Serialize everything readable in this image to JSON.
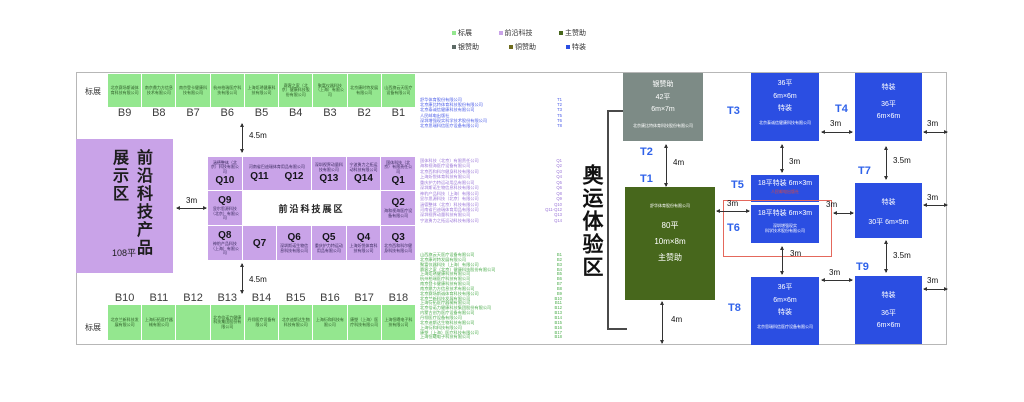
{
  "legend": {
    "items": [
      {
        "label": "标展",
        "color": "#94e78f"
      },
      {
        "label": "前沿科技",
        "color": "#c9a3e8"
      },
      {
        "label": "主赞助",
        "color": "#47671c"
      },
      {
        "label": "银赞助",
        "color": "#5d6a66"
      },
      {
        "label": "铜赞助",
        "color": "#6e6b1d"
      },
      {
        "label": "特装",
        "color": "#2b4ee2"
      }
    ]
  },
  "colors": {
    "standard_booth": "#94e78f",
    "frontier_zone": "#c9a3e8",
    "main_sponsor": "#47671c",
    "silver_sponsor": "#7d8b86",
    "bronze_sponsor": "#6e6b1d",
    "special_booth": "#2b4ee2",
    "t_label_text": "#2f62ea",
    "red_highlight": "#e4685c"
  },
  "labels": {
    "standard_top": "标展",
    "standard_bottom": "标展"
  },
  "hall": {
    "top_row": [
      {
        "code": "B9",
        "company": "北京赛场斯诚体育科技有限公司"
      },
      {
        "code": "B8",
        "company": "南京鼎力方信息技术有限公司"
      },
      {
        "code": "B7",
        "company": "南京登卡健康科技有限公司"
      },
      {
        "code": "B6",
        "company": "杭州柏瑞医疗科技有限公司"
      },
      {
        "code": "B5",
        "company": "上海炬琇健康科技有限公司"
      },
      {
        "code": "B4",
        "company": "赛客之家（北京）健康科技股份有限公司"
      },
      {
        "code": "B3",
        "company": "聚富仪器科技（上海）有限公司"
      },
      {
        "code": "B2",
        "company": "北京康时特发展有限公司"
      },
      {
        "code": "B1",
        "company": "山西旗云天医疗设备有限公司"
      }
    ],
    "bottom_row": [
      {
        "code": "B10",
        "company": "北京兰新科技发展有限公司"
      },
      {
        "code": "B11",
        "company": "上海衍拓医疗器械有限公司"
      },
      {
        "code": "B12",
        "company": ""
      },
      {
        "code": "B13",
        "company": "北京倍诺力健康科技集团股份有限公司"
      },
      {
        "code": "B14",
        "company": "丹翎医疗设备有限公司"
      },
      {
        "code": "B15",
        "company": "北京迪斯达生物科技有限公司"
      },
      {
        "code": "B16",
        "company": "上海衍和科技有限公司"
      },
      {
        "code": "B17",
        "company": "康塑（上海）医疗科技有限公司"
      },
      {
        "code": "B18",
        "company": "上海恒曦电子科技有限公司"
      }
    ]
  },
  "frontier_zone": {
    "title_right": "前沿科技",
    "title_left": "产品展示区",
    "area": "108平"
  },
  "q_grid": {
    "center_label": "前沿科技展区",
    "q10": {
      "code": "Q10",
      "company": "涵德整体（北京）科技有限公司"
    },
    "q11_12": {
      "code_a": "Q11",
      "code_b": "Q12",
      "company": "河南省巴迪瑞体育用品有限公司"
    },
    "q13": {
      "code": "Q13",
      "company": "深圳视界动量科技有限公司"
    },
    "q14": {
      "code": "Q14",
      "company": "宁波勇力之拓运动科技有限公司"
    },
    "q1": {
      "code": "Q1",
      "company": "国体科技（北京）有限责任公司"
    },
    "q9": {
      "code": "Q9",
      "company": "显尔思源科技（北京）有限公司"
    },
    "q2": {
      "code": "Q2",
      "company": "海和视海医疗设备有限公司"
    },
    "q8": {
      "code": "Q8",
      "company": "神豹产品科技（上海）有限公司"
    },
    "q7": {
      "code": "Q7",
      "company": ""
    },
    "q6": {
      "code": "Q6",
      "company": "深圳斯诺生物信息科技有限公司"
    },
    "q5": {
      "code": "Q5",
      "company": "重庆护力特运动用品有限公司"
    },
    "q4": {
      "code": "Q4",
      "company": "上海炘悦体育科技有限公司"
    },
    "q3": {
      "code": "Q3",
      "company": "北京西和科尔健身科技有限公司"
    }
  },
  "directory": {
    "t_list": [
      {
        "name": "舒华体育股份有限公司",
        "code": "T1"
      },
      {
        "name": "北京康比特体育科技股份有限公司",
        "code": "T2"
      },
      {
        "name": "北京泰诚信健康科技有限公司",
        "code": "T3"
      },
      {
        "name": "人民邮电出版社",
        "code": "T5"
      },
      {
        "name": "深圳增强现实科学技术股份有限公司",
        "code": "T6"
      },
      {
        "name": "北京思瑞科信医疗设备有限公司",
        "code": "T8"
      }
    ],
    "q_list": [
      {
        "name": "国体科技（北京）有限责任公司",
        "code": "Q1"
      },
      {
        "name": "海和视海医疗设备有限公司",
        "code": "Q2"
      },
      {
        "name": "北京西和科尔健身科技有限公司",
        "code": "Q3"
      },
      {
        "name": "上海炘悦体育科技有限公司",
        "code": "Q4"
      },
      {
        "name": "重庆护力特运动用品有限公司",
        "code": "Q5"
      },
      {
        "name": "深圳斯诺生物信息科技有限公司",
        "code": "Q6"
      },
      {
        "name": "神豹产品科技（上海）有限公司",
        "code": "Q8"
      },
      {
        "name": "显尔思源科技（北京）有限公司",
        "code": "Q9"
      },
      {
        "name": "涵德整体（北京）科技有限公司",
        "code": "Q10"
      },
      {
        "name": "河南省巴迪瑞体育用品有限公司",
        "code": "Q11-Q12"
      },
      {
        "name": "深圳视界动量科技有限公司",
        "code": "Q13"
      },
      {
        "name": "宁波勇力之拓运动科技有限公司",
        "code": "Q14"
      }
    ],
    "b_list": [
      {
        "name": "山西旗云天医疗设备有限公司",
        "code": "B1"
      },
      {
        "name": "北京康时特发展有限公司",
        "code": "B2"
      },
      {
        "name": "聚富仪器科技（上海）有限公司",
        "code": "B3"
      },
      {
        "name": "赛客之家（北京）健康科技股份有限公司",
        "code": "B4"
      },
      {
        "name": "上海炬琇健康科技有限公司",
        "code": "B5"
      },
      {
        "name": "杭州柏瑞医疗科技有限公司",
        "code": "B6"
      },
      {
        "name": "南京登卡健康科技有限公司",
        "code": "B7"
      },
      {
        "name": "南京鼎力方信息技术有限公司",
        "code": "B8"
      },
      {
        "name": "北京赛场斯诚体育科技有限公司",
        "code": "B9"
      },
      {
        "name": "北京兰新科技发展有限公司",
        "code": "B10"
      },
      {
        "name": "上海衍拓医疗器械有限公司",
        "code": "B11"
      },
      {
        "name": "北京倍诺力健康科技集团股份有限公司",
        "code": "B12"
      },
      {
        "name": "内蒙古创为医疗设备有限公司",
        "code": "B13"
      },
      {
        "name": "丹翎医疗设备有限公司",
        "code": "B14"
      },
      {
        "name": "北京迪斯达生物科技有限公司",
        "code": "B15"
      },
      {
        "name": "上海衍和科技有限公司",
        "code": "B16"
      },
      {
        "name": "康塑（上海）医疗科技有限公司",
        "code": "B17"
      },
      {
        "name": "上海恒曦电子科技有限公司",
        "code": "B18"
      }
    ]
  },
  "dims": {
    "top_aisle": "4.5m",
    "bottom_aisle": "4.5m",
    "purple_gap": "3m",
    "silver_main_gap": "4m",
    "main_bottom_gap": "4m",
    "t3_t4": "3m",
    "t4_edge": "3m",
    "t3_t5": "3m",
    "t4_t7": "3.5m",
    "t7_edge": "3m",
    "main_t5": "3m",
    "t6_t7": "3m",
    "t6_t8": "3m",
    "t8_t9": "3m",
    "t7_t9": "3.5m",
    "t9_edge": "3m"
  },
  "olympic": {
    "zone_label": "奥运体验区",
    "t_labels": {
      "t1": "T1",
      "t2": "T2",
      "t3": "T3",
      "t4": "T4",
      "t5": "T5",
      "t6": "T6",
      "t7": "T7",
      "t8": "T8",
      "t9": "T9"
    },
    "silver_box": {
      "lines": [
        "银赞助",
        "42平",
        "6m×7m"
      ],
      "company": "北京康比特体育科技股份有限公司"
    },
    "main_box": {
      "company": "舒华体育股份有限公司",
      "lines": [
        "80平",
        "10m×8m",
        "主赞助"
      ]
    },
    "t3_box": {
      "lines": [
        "36平",
        "6m×6m",
        "特装"
      ],
      "company": "北京泰诚信健康科技有限公司"
    },
    "t4_box": {
      "lines": [
        "特装",
        "36平",
        "6m×6m"
      ]
    },
    "t5_box": {
      "text": "18平特装 6m×3m",
      "company": "人民邮电出版社"
    },
    "t6_box": {
      "text": "18平特装 6m×3m",
      "company_lines": [
        "深圳增强现实",
        "科学技术股份有限公司"
      ]
    },
    "t7_box": {
      "lines": [
        "特装",
        "30平 6m×5m"
      ]
    },
    "t8_box": {
      "lines": [
        "36平",
        "6m×6m",
        "特装"
      ],
      "company": "北京思瑞科信医疗设备有限公司"
    },
    "t9_box": {
      "lines": [
        "特装",
        "36平",
        "6m×6m"
      ]
    }
  }
}
